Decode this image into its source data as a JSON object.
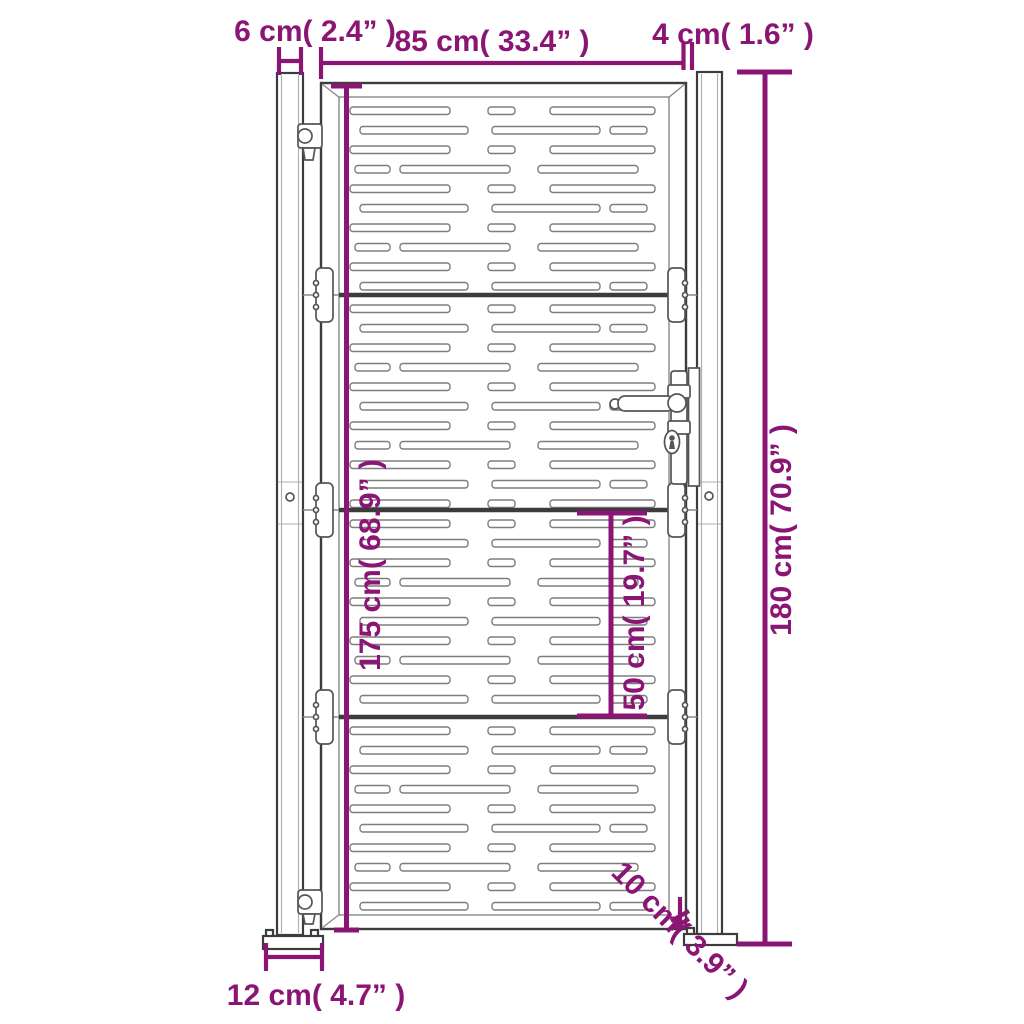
{
  "title": "Garden gate dimension diagram",
  "colors": {
    "accent": "#8B1574",
    "outline": "#3C3C3C",
    "detail": "#8A8A8A",
    "background": "#FFFFFF"
  },
  "dimensions": {
    "post_width": "6 cm( 2.4” )",
    "gate_width": "85 cm( 33.4” )",
    "gap_width": "4 cm( 1.6” )",
    "total_height": "180 cm( 70.9” )",
    "gate_height": "175 cm( 68.9” )",
    "section_height": "50 cm( 19.7” )",
    "ground_clearance": "10 cm( 3.9” )",
    "base_plate_width": "12 cm( 4.7” )"
  }
}
